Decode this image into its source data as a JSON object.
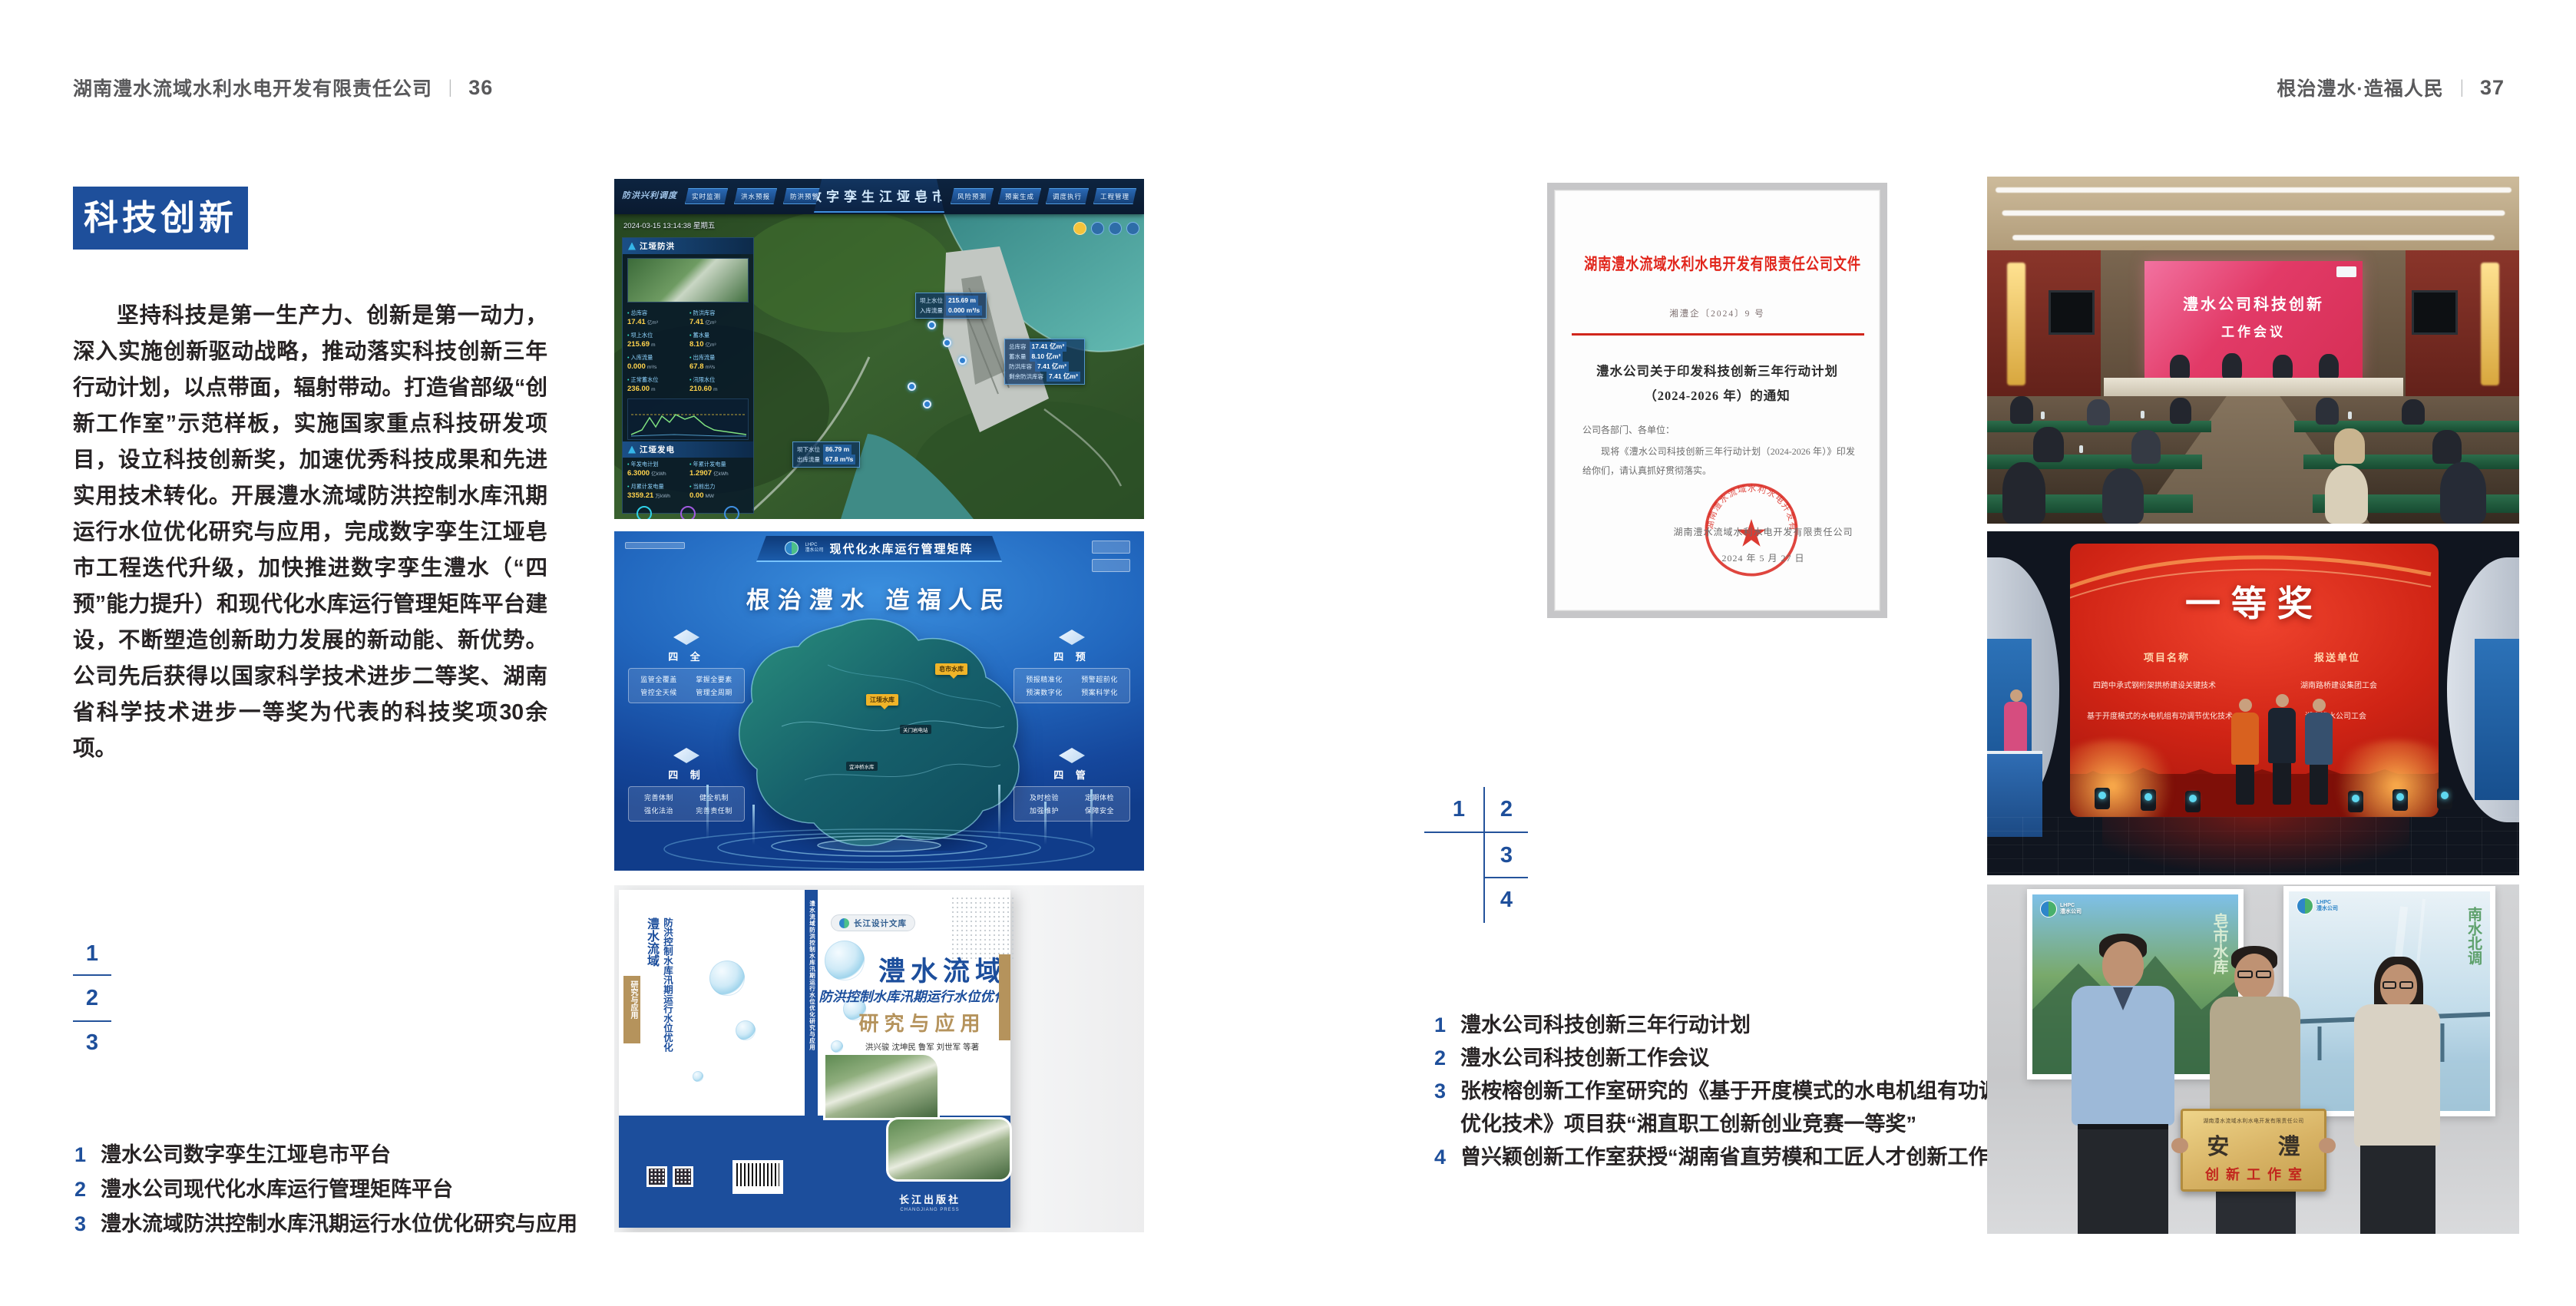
{
  "colors": {
    "accent_blue": "#1e4f9b",
    "text_dark": "#272324",
    "header_gray": "#59595b",
    "doc_red": "#d9251c",
    "book_tan": "#b5935c",
    "meeting_screen_pink": "#e23a67",
    "award_screen_red": "#d02415"
  },
  "left_page": {
    "header": {
      "company": "湖南澧水流域水利水电开发有限责任公司",
      "divider": "|",
      "page_no": "36"
    },
    "section_title": "科技创新",
    "paragraph": "坚持科技是第一生产力、创新是第一动力，深入实施创新驱动战略，推动落实科技创新三年行动计划，以点带面，辐射带动。打造省部级“创新工作室”示范样板，实施国家重点科技研发项目，设立科技创新奖，加速优秀科技成果和先进实用技术转化。开展澧水流域防洪控制水库汛期运行水位优化研究与应用，完成数字孪生江垭皂市工程迭代升级，加快推进数字孪生澧水（“四预”能力提升）和现代化水库运行管理矩阵平台建设，不断塑造创新助力发展的新动能、新优势。公司先后获得以国家科学技术进步二等奖、湖南省科学技术进步一等奖为代表的科技奖项30余项。",
    "figure_index": {
      "n1": "1",
      "n2": "2",
      "n3": "3"
    },
    "captions": [
      {
        "num": "1",
        "text": "澧水公司数字孪生江垭皂市平台"
      },
      {
        "num": "2",
        "text": "澧水公司现代化水库运行管理矩阵平台"
      },
      {
        "num": "3",
        "text": "澧水流域防洪控制水库汛期运行水位优化研究与应用"
      }
    ]
  },
  "right_page": {
    "header": {
      "slogan": "根治澧水·造福人民",
      "divider": "|",
      "page_no": "37"
    },
    "figure_index": {
      "n1": "1",
      "n2": "2",
      "n3": "3",
      "n4": "4"
    },
    "captions": [
      {
        "num": "1",
        "text": "澧水公司科技创新三年行动计划"
      },
      {
        "num": "2",
        "text": "澧水公司科技创新工作会议"
      },
      {
        "num": "3",
        "text": "张桉榕创新工作室研究的《基于开度模式的水电机组有功调节优化技术》项目获“湘直职工创新创业竞赛一等奖”"
      },
      {
        "num": "4",
        "text": "曾兴颖创新工作室获授“湖南省直劳模和工匠人才创新工作室”"
      }
    ]
  },
  "digital_twin": {
    "title": "数字孪生江垭皂市",
    "mode_label": "防洪兴利调度",
    "timestamp": "2024-03-15 13:14:38 星期五",
    "tabs_left": [
      "实时监测",
      "洪水预报",
      "防洪预警"
    ],
    "tabs_right": [
      "风险预测",
      "预案生成",
      "调度执行",
      "工程管理"
    ],
    "panel_flood": {
      "title": "江垭防洪",
      "stats": [
        {
          "label": "总库容",
          "value": "17.41",
          "unit": "亿m³"
        },
        {
          "label": "防洪库容",
          "value": "7.41",
          "unit": "亿m³"
        },
        {
          "label": "坝上水位",
          "value": "215.69",
          "unit": "m"
        },
        {
          "label": "蓄水量",
          "value": "8.10",
          "unit": "亿m³"
        },
        {
          "label": "入库流量",
          "value": "0.000",
          "unit": "m³/s"
        },
        {
          "label": "出库流量",
          "value": "67.8",
          "unit": "m³/s"
        },
        {
          "label": "正常蓄水位",
          "value": "236.00",
          "unit": "m"
        },
        {
          "label": "汛限水位",
          "value": "210.60",
          "unit": "m"
        }
      ]
    },
    "panel_power": {
      "title": "江垭发电",
      "stats": [
        {
          "label": "年发电计划",
          "value": "6.3000",
          "unit": "亿kWh"
        },
        {
          "label": "年累计发电量",
          "value": "1.2907",
          "unit": "亿kWh"
        },
        {
          "label": "月累计发电量",
          "value": "3359.21",
          "unit": "万kWh"
        },
        {
          "label": "当前出力",
          "value": "0.00",
          "unit": "MW"
        }
      ]
    },
    "tag_upstream": {
      "rows": [
        {
          "label": "坝上水位",
          "value": "215.69 m"
        },
        {
          "label": "入库流量",
          "value": "0.000 m³/s"
        }
      ]
    },
    "tag_capacity": {
      "rows": [
        {
          "label": "总库容",
          "value": "17.41 亿m³"
        },
        {
          "label": "蓄水量",
          "value": "8.10 亿m³"
        },
        {
          "label": "防洪库容",
          "value": "7.41 亿m³"
        },
        {
          "label": "剩余防洪库容",
          "value": "7.41 亿m³"
        }
      ]
    },
    "tag_downstream": {
      "rows": [
        {
          "label": "坝下水位",
          "value": "86.79 m"
        },
        {
          "label": "出库流量",
          "value": "67.8 m³/s"
        }
      ]
    }
  },
  "matrix": {
    "logo_top": "LHPC",
    "logo_bottom": "澧水公司",
    "title": "现代化水库运行管理矩阵",
    "slogan": "根治澧水 造福人民",
    "panels": [
      {
        "title": "四 全",
        "items": [
          "监管全覆盖",
          "掌握全要素",
          "管控全天候",
          "管理全周期"
        ]
      },
      {
        "title": "四 制",
        "items": [
          "完善体制",
          "健全机制",
          "强化法治",
          "完善责任制"
        ]
      },
      {
        "title": "四 预",
        "items": [
          "预报精准化",
          "预警超前化",
          "预演数字化",
          "预案科学化"
        ]
      },
      {
        "title": "四 管",
        "items": [
          "及时检验",
          "定期体检",
          "加强维护",
          "保障安全"
        ]
      }
    ],
    "map_tags": {
      "jiangya": "江垭水库",
      "zaoshi": "皂市水库",
      "guanmenyan": "关门岩电站",
      "yichongqiao": "宜冲桥水库"
    }
  },
  "book": {
    "series": "长江设计文库",
    "title_main": "澧水流域",
    "title_sub": "防洪控制水库汛期运行水位优化",
    "title_tail": "研究与应用",
    "authors": "洪兴骏  沈坤民  鲁军  刘世军  等著",
    "publisher": "长江出版社",
    "publisher_latin": "CHANGJIANG PRESS",
    "spine_text": "澧水流域防洪控制水库汛期运行水位优化研究与应用"
  },
  "document": {
    "header": "湖南澧水流域水利水电开发有限责任公司文件",
    "doc_no": "湘澧企〔2024〕9 号",
    "title_line1": "澧水公司关于印发科技创新三年行动计划",
    "title_line2": "（2024-2026 年）的通知",
    "salutation": "公司各部门、各单位：",
    "body": "现将《澧水公司科技创新三年行动计划（2024-2026 年）》印发给你们，请认真抓好贯彻落实。",
    "signer": "湖南澧水流域水利水电开发有限责任公司",
    "date": "2024 年 5 月 27 日"
  },
  "meeting": {
    "screen_line1": "澧水公司科技创新",
    "screen_line2": "工作会议"
  },
  "award": {
    "screen_title": "一等奖",
    "col1_header": "项目名称",
    "col2_header": "报送单位",
    "rows": [
      {
        "project": "四跨中承式钢桁架拱桥建设关键技术",
        "unit": "湖南路桥建设集团工会"
      },
      {
        "project": "基于开度模式的水电机组有功调节优化技术",
        "unit": "湖南澧水公司工会"
      }
    ]
  },
  "workshop": {
    "poster_left_label": "皂市水库",
    "poster_right_label": "南水北调",
    "plaque_top": "湖南澧水流域水利水电开发有限责任公司",
    "plaque_main": "安 澧",
    "plaque_sub": "创新工作室"
  }
}
